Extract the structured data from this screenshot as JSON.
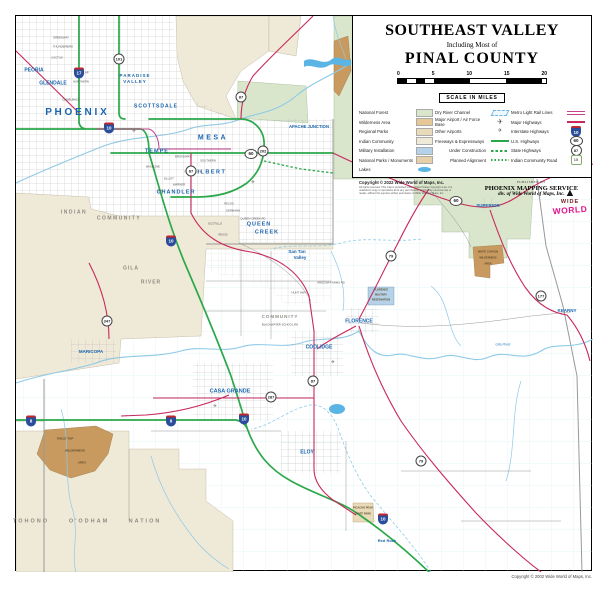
{
  "palette": {
    "freeway": "#2ba84a",
    "highway": "#c8285a",
    "lightrail": "#c2408e",
    "river": "#8ecae6",
    "lake": "#5ab4e4",
    "forest": "#d9e6cc",
    "indian": "#efe9d8",
    "wilderness": "#c89a5f",
    "military": "#b5d2e8",
    "parks": "#e9dbba",
    "county": "#999999",
    "citytext": "#1a64ad",
    "areatext": "#8c8c80"
  },
  "title_block": {
    "line1": "SOUTHEAST VALLEY",
    "line2": "Including Most of",
    "line3": "PINAL COUNTY"
  },
  "scale_bar": {
    "ticks": [
      "0",
      "5",
      "10",
      "15",
      "20"
    ],
    "caption": "SCALE IN MILES"
  },
  "legend": {
    "col1": [
      {
        "label": "National Forest",
        "swatch": "forest"
      },
      {
        "label": "Wilderness Area",
        "swatch": "wilderness"
      },
      {
        "label": "Regional Parks",
        "swatch": "parks"
      },
      {
        "label": "Indian Community",
        "swatch": "indian"
      },
      {
        "label": "Military Installation",
        "swatch": "military"
      },
      {
        "label": "National Parks / Monuments",
        "swatch": "monuments"
      },
      {
        "label": "Lakes",
        "swatch": "lake"
      }
    ],
    "col2": [
      {
        "label": "Dry River Channel",
        "icon": "drychannel"
      },
      {
        "label": "Major Airport / Air Force Base",
        "icon": "airport-major"
      },
      {
        "label": "Other Airports",
        "icon": "airport-other"
      },
      {
        "label": "Freeways & Expressways",
        "icon": "freeway"
      },
      {
        "label": "Under Construction",
        "icon": "construction",
        "indent": true
      },
      {
        "label": "Planned Alignment",
        "icon": "planned",
        "indent": true
      }
    ],
    "col3": [
      {
        "label": "Metro Light Rail Lines",
        "icon": "lightrail"
      },
      {
        "label": "Major Highways",
        "icon": "highway"
      },
      {
        "label": "Interstate Highways",
        "icon": "shield-i",
        "num": "10"
      },
      {
        "label": "U.S. Highways",
        "icon": "shield-us",
        "num": "60"
      },
      {
        "label": "State Highways",
        "icon": "shield-st",
        "num": "87"
      },
      {
        "label": "Indian Community Road",
        "icon": "shield-ic",
        "num": "15"
      }
    ]
  },
  "copyright_block": {
    "line1": "Copyright ©  2022 Wide World of Maps, Inc.",
    "fine_print": [
      "All rights reserved. This map is protected under United States Copyright Law. It is",
      "unlawful to copy or reproduce all or any part thereof, whether for personal use or",
      "resale, without the express written permission of Wide World of Maps, Inc."
    ]
  },
  "publisher_block": {
    "published_by": "PUBLISHED BY",
    "name": "PHOENIX MAPPING SERVICE",
    "division": "div. of Wide World of Maps, Inc."
  },
  "logo": {
    "line1": "WIDE",
    "line2": "WORLD"
  },
  "bottom_copyright": "Copyright © 2002 Wide World of Maps, Inc.",
  "map": {
    "labels": [
      {
        "t": "P H O E N I X",
        "cls": "city",
        "x": 75,
        "y": 112,
        "fs": 10
      },
      {
        "t": "PEORIA",
        "cls": "city",
        "x": 33,
        "y": 70,
        "fs": 5
      },
      {
        "t": "GLENDALE",
        "cls": "city",
        "x": 52,
        "y": 83,
        "fs": 5
      },
      {
        "t": "PARADISE",
        "cls": "city",
        "x": 134,
        "y": 75,
        "fs": 4.5,
        "ls": 1
      },
      {
        "t": "VALLEY",
        "cls": "city",
        "x": 134,
        "y": 81,
        "fs": 4.5,
        "ls": 1
      },
      {
        "t": "SCOTTSDALE",
        "cls": "city",
        "x": 155,
        "y": 106,
        "fs": 5,
        "ls": 1
      },
      {
        "t": "TEMPE",
        "cls": "city",
        "x": 156,
        "y": 151,
        "fs": 5.5,
        "ls": 1
      },
      {
        "t": "MESA",
        "cls": "city",
        "x": 212,
        "y": 137,
        "fs": 7,
        "ls": 2.5
      },
      {
        "t": "GILBERT",
        "cls": "city",
        "x": 208,
        "y": 172,
        "fs": 5.5,
        "ls": 1.5
      },
      {
        "t": "CHANDLER",
        "cls": "city",
        "x": 175,
        "y": 192,
        "fs": 5.5,
        "ls": 1
      },
      {
        "t": "APACHE JUNCTION",
        "cls": "city",
        "x": 308,
        "y": 126,
        "fs": 4.2
      },
      {
        "t": "QUEEN",
        "cls": "city",
        "x": 258,
        "y": 224,
        "fs": 5.5,
        "ls": 1
      },
      {
        "t": "CREEK",
        "cls": "city",
        "x": 266,
        "y": 232,
        "fs": 5.5,
        "ls": 1
      },
      {
        "t": "San Tan",
        "cls": "city",
        "x": 296,
        "y": 251,
        "fs": 4.5
      },
      {
        "t": "Valley",
        "cls": "city",
        "x": 299,
        "y": 257,
        "fs": 4.5
      },
      {
        "t": "FLORENCE",
        "cls": "city",
        "x": 358,
        "y": 321,
        "fs": 5
      },
      {
        "t": "COOLIDGE",
        "cls": "city",
        "x": 318,
        "y": 347,
        "fs": 5
      },
      {
        "t": "CASA GRANDE",
        "cls": "city",
        "x": 229,
        "y": 391,
        "fs": 5.5
      },
      {
        "t": "ELOY",
        "cls": "city",
        "x": 306,
        "y": 452,
        "fs": 5
      },
      {
        "t": "MARICOPA",
        "cls": "city",
        "x": 90,
        "y": 351,
        "fs": 4.5
      },
      {
        "t": "SUPERIOR",
        "cls": "city",
        "x": 487,
        "y": 205,
        "fs": 4.5
      },
      {
        "t": "KEARNY",
        "cls": "city",
        "x": 566,
        "y": 310,
        "fs": 4.5
      },
      {
        "t": "Red Rock",
        "cls": "city",
        "x": 386,
        "y": 540,
        "fs": 4
      },
      {
        "t": "Top of the World",
        "cls": "city",
        "x": 510,
        "y": 176,
        "fs": 3.2
      },
      {
        "t": "INDIAN",
        "cls": "area",
        "x": 73,
        "y": 212,
        "fs": 5,
        "ls": 1.5
      },
      {
        "t": "COMMUNITY",
        "cls": "area",
        "x": 118,
        "y": 218,
        "fs": 5,
        "ls": 1.5
      },
      {
        "t": "GILA",
        "cls": "area",
        "x": 130,
        "y": 268,
        "fs": 5,
        "ls": 1
      },
      {
        "t": "RIVER",
        "cls": "area",
        "x": 150,
        "y": 282,
        "fs": 5,
        "ls": 1
      },
      {
        "t": "COMMUNITY",
        "cls": "area",
        "x": 279,
        "y": 316,
        "fs": 4.5,
        "ls": 1
      },
      {
        "t": "TOHONO",
        "cls": "area",
        "x": 30,
        "y": 521,
        "fs": 5.5,
        "ls": 2
      },
      {
        "t": "O'ODHAM",
        "cls": "area",
        "x": 88,
        "y": 521,
        "fs": 5.5,
        "ls": 2
      },
      {
        "t": "NATION",
        "cls": "area",
        "x": 144,
        "y": 521,
        "fs": 5.5,
        "ls": 2
      },
      {
        "t": "FOREST",
        "cls": "area",
        "x": 470,
        "y": 176,
        "fs": 4.5,
        "ls": 1
      },
      {
        "t": "TABLE TOP",
        "cls": "wild",
        "x": 64,
        "y": 438,
        "fs": 3
      },
      {
        "t": "WILDERNESS",
        "cls": "wild",
        "x": 74,
        "y": 450,
        "fs": 3
      },
      {
        "t": "AREA",
        "cls": "wild",
        "x": 81,
        "y": 462,
        "fs": 3
      },
      {
        "t": "WHITE CANYON",
        "cls": "wild",
        "x": 487,
        "y": 252,
        "fs": 2.6
      },
      {
        "t": "WILDERNESS",
        "cls": "wild",
        "x": 487,
        "y": 258,
        "fs": 2.6
      },
      {
        "t": "AREA",
        "cls": "wild",
        "x": 487,
        "y": 264,
        "fs": 2.6
      },
      {
        "t": "FLORENCE",
        "cls": "wild",
        "x": 380,
        "y": 290,
        "fs": 2.6
      },
      {
        "t": "MILITARY",
        "cls": "wild",
        "x": 380,
        "y": 295,
        "fs": 2.6
      },
      {
        "t": "RESERVATION",
        "cls": "wild",
        "x": 380,
        "y": 300,
        "fs": 2.6
      },
      {
        "t": "PICACHO PEAK",
        "cls": "wild",
        "x": 362,
        "y": 508,
        "fs": 2.6
      },
      {
        "t": "STATE PARK",
        "cls": "wild",
        "x": 362,
        "y": 514,
        "fs": 2.6
      },
      {
        "t": "Gila River",
        "cls": "water",
        "x": 502,
        "y": 344,
        "fs": 3.5
      },
      {
        "t": "BLACKWATER SCHOOL RD",
        "cls": "st-lbl",
        "x": 279,
        "y": 324
      },
      {
        "t": "GREENWAY",
        "cls": "st-lbl",
        "x": 60,
        "y": 37
      },
      {
        "t": "THUNDERBIRD",
        "cls": "st-lbl",
        "x": 62,
        "y": 46
      },
      {
        "t": "CACTUS",
        "cls": "st-lbl",
        "x": 56,
        "y": 57
      },
      {
        "t": "DUNLAP",
        "cls": "st-lbl",
        "x": 82,
        "y": 72
      },
      {
        "t": "NORTHERN",
        "cls": "st-lbl",
        "x": 80,
        "y": 81
      },
      {
        "t": "CAMELBACK",
        "cls": "st-lbl",
        "x": 70,
        "y": 99
      },
      {
        "t": "BROADWAY",
        "cls": "st-lbl",
        "x": 182,
        "y": 156
      },
      {
        "t": "SOUTHERN",
        "cls": "st-lbl",
        "x": 207,
        "y": 160
      },
      {
        "t": "BASELINE",
        "cls": "st-lbl",
        "x": 152,
        "y": 166
      },
      {
        "t": "GUADALUPE",
        "cls": "st-lbl",
        "x": 192,
        "y": 171
      },
      {
        "t": "ELLIOT",
        "cls": "st-lbl",
        "x": 168,
        "y": 178
      },
      {
        "t": "WARNER",
        "cls": "st-lbl",
        "x": 178,
        "y": 184
      },
      {
        "t": "RAY",
        "cls": "st-lbl",
        "x": 160,
        "y": 190
      },
      {
        "t": "PECOS",
        "cls": "st-lbl",
        "x": 228,
        "y": 203
      },
      {
        "t": "GERMANN",
        "cls": "st-lbl",
        "x": 232,
        "y": 210
      },
      {
        "t": "QUEEN CREEK RD",
        "cls": "st-lbl",
        "x": 252,
        "y": 218
      },
      {
        "t": "OCOTILLO",
        "cls": "st-lbl",
        "x": 214,
        "y": 223
      },
      {
        "t": "RIGGS",
        "cls": "st-lbl",
        "x": 222,
        "y": 234
      },
      {
        "t": "HUNT HWY",
        "cls": "st-lbl",
        "x": 298,
        "y": 292
      },
      {
        "t": "ARIZONA FARMS RD",
        "cls": "st-lbl",
        "x": 330,
        "y": 282
      },
      {
        "t": "✈",
        "cls": "apt",
        "x": 133,
        "y": 131,
        "fs": 5
      },
      {
        "t": "✈",
        "cls": "apt",
        "x": 252,
        "y": 182,
        "fs": 5
      },
      {
        "t": "✈",
        "cls": "apt",
        "x": 214,
        "y": 406,
        "fs": 5
      },
      {
        "t": "✈",
        "cls": "apt",
        "x": 332,
        "y": 362,
        "fs": 5
      }
    ],
    "shields": [
      {
        "type": "i",
        "num": "10",
        "x": 108,
        "y": 127
      },
      {
        "type": "i",
        "num": "17",
        "x": 78,
        "y": 72
      },
      {
        "type": "i",
        "num": "10",
        "x": 170,
        "y": 240
      },
      {
        "type": "i",
        "num": "10",
        "x": 243,
        "y": 418
      },
      {
        "type": "i",
        "num": "10",
        "x": 382,
        "y": 518
      },
      {
        "type": "i",
        "num": "8",
        "x": 30,
        "y": 420
      },
      {
        "type": "i",
        "num": "8",
        "x": 170,
        "y": 420
      },
      {
        "type": "us",
        "num": "60",
        "x": 250,
        "y": 153
      },
      {
        "type": "us",
        "num": "60",
        "x": 455,
        "y": 200
      },
      {
        "type": "st",
        "num": "101",
        "x": 118,
        "y": 58
      },
      {
        "type": "st",
        "num": "202",
        "x": 262,
        "y": 150
      },
      {
        "type": "st",
        "num": "87",
        "x": 190,
        "y": 170
      },
      {
        "type": "st",
        "num": "87",
        "x": 240,
        "y": 96
      },
      {
        "type": "st",
        "num": "87",
        "x": 312,
        "y": 380
      },
      {
        "type": "st",
        "num": "79",
        "x": 390,
        "y": 255
      },
      {
        "type": "st",
        "num": "79",
        "x": 420,
        "y": 460
      },
      {
        "type": "st",
        "num": "287",
        "x": 270,
        "y": 396
      },
      {
        "type": "st",
        "num": "177",
        "x": 540,
        "y": 295
      },
      {
        "type": "st",
        "num": "347",
        "x": 106,
        "y": 320
      }
    ]
  }
}
